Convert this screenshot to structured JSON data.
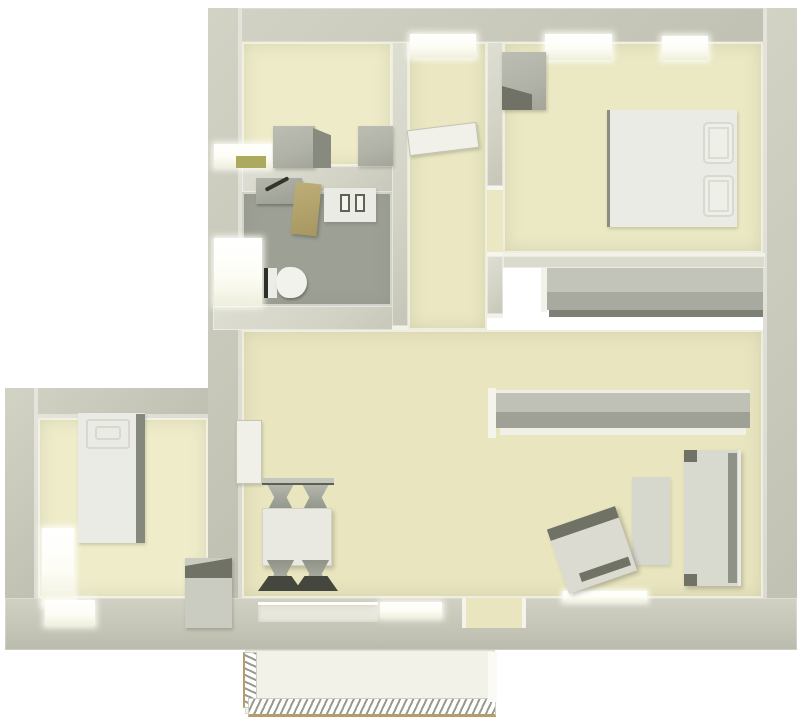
{
  "meta": {
    "title": "3D top-down floor plan render of an apartment",
    "view": "top-down 3D architectural render, no text labels",
    "background": "#ffffff"
  },
  "palette": {
    "wall": "#c9c9bb",
    "wall_highlight": "#ecece2",
    "floor_living": "#e8e5bf",
    "floor_kitchen": "#eeebc8",
    "floor_bedroom": "#ebe8c4",
    "floor_small_bedroom": "#efecca",
    "floor_bathroom": "#9da095",
    "floor_balcony": "#f3f2e9",
    "furniture_gray": "#b0b2a7",
    "furniture_gray_dark": "#6f7265",
    "furniture_white": "#ebebe5",
    "shower_screen_tan": "#b3a26b",
    "kitchen_sill_olive": "#abaa5e",
    "railing_tan": "#b49c6c"
  },
  "rooms": {
    "kitchen": {
      "label": "Kitchen",
      "furniture": [
        "base cabinet",
        "appliance cabinet",
        "window with olive sill",
        "top-wall window"
      ]
    },
    "bathroom": {
      "label": "Bathroom",
      "furniture": [
        "washbasin with faucet",
        "tan shower screen",
        "washing machine",
        "toilet",
        "window"
      ]
    },
    "entry_hall": {
      "label": "Entry hall",
      "furniture": [
        "open entrance door",
        "entrance opening"
      ]
    },
    "bedroom": {
      "label": "Bedroom",
      "furniture": [
        "double bed with two pillows",
        "wardrobe",
        "built-in closet row",
        "two top-wall windows",
        "doorway"
      ]
    },
    "living_room": {
      "label": "Living and dining room",
      "furniture": [
        "dining table",
        "four chairs",
        "long sideboard",
        "sofa",
        "tilted armchair",
        "coffee table rug",
        "balcony door",
        "bottom-wall windows",
        "door to small bedroom"
      ]
    },
    "small_bedroom": {
      "label": "Small bedroom",
      "furniture": [
        "single bed with headboard",
        "dresser",
        "side window",
        "bottom window"
      ]
    },
    "balcony": {
      "label": "Balcony",
      "furniture": [
        "hatched metal railing"
      ]
    }
  }
}
